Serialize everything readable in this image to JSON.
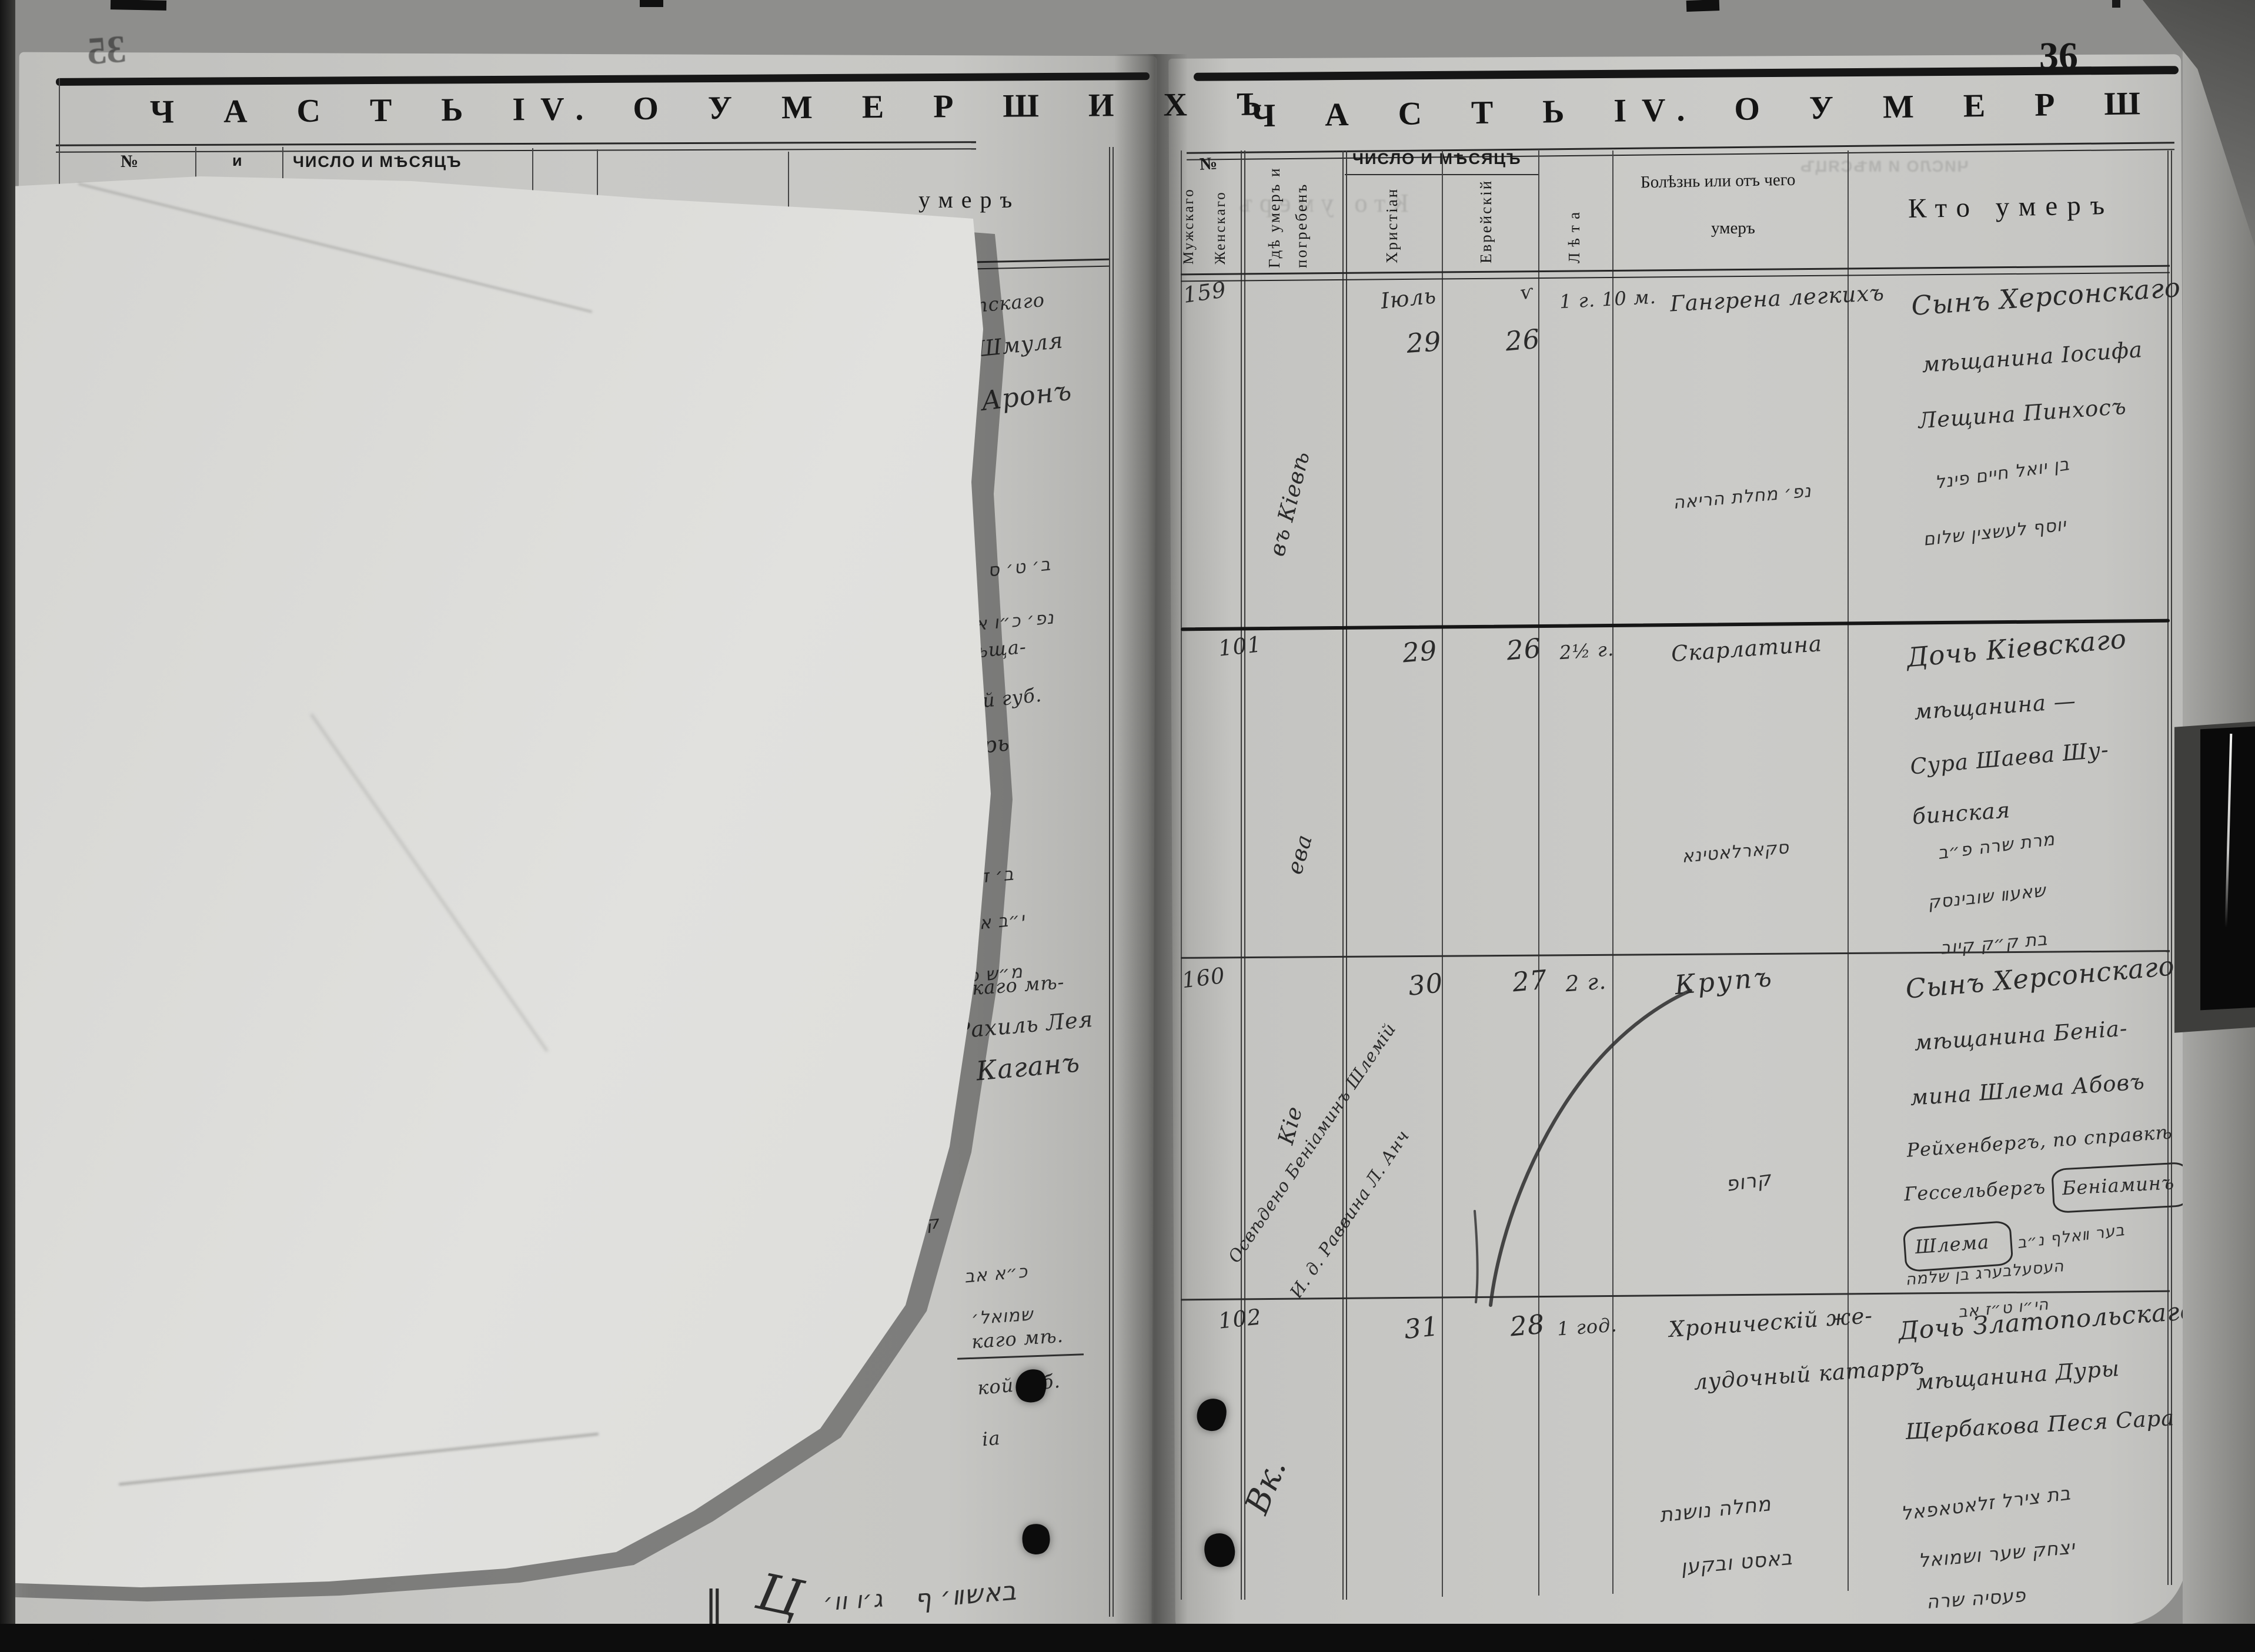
{
  "document_type": "metrical book scan",
  "colors": {
    "page": "#c8c8c5",
    "overlay_paper": "#dededb",
    "ink_printed": "#1a1a1a",
    "ink_handwriting": "#2a2a2a",
    "background": "#8e8e8c",
    "clamp": "#0a0a0a"
  },
  "pages": {
    "left": {
      "page_number": "35",
      "header": "Ч А С Т Ь  IV.  О  У М Е Р Ш И Х Ъ",
      "columns": {
        "no": "№",
        "where_fragment": "и",
        "date": "ЧИСЛО И МѢСЯЦЪ",
        "who_fragment": "умеръ"
      },
      "entries": [
        {
          "lines": [
            "нотопскаго",
            "на Шмуля",
            "та Аронъ"
          ],
          "hebrew": [
            "ב׳ ט׳ ס",
            "נפ׳ כ״ו אב"
          ]
        },
        {
          "lines": [
            "ій мѣща-",
            "вской губ.",
            "окарь"
          ],
          "hebrew": [
            "ב׳ ד",
            "י״ב אלול",
            "מ״ש פ׳"
          ]
        },
        {
          "lines": [
            "нскаго мѣ-",
            "Рахиль Лея",
            "Каганъ"
          ],
          "hebrew": [
            "ק׳ ל׳",
            "כ״א אב",
            "שמואל׳"
          ]
        },
        {
          "lines": [
            "каго мѣ.",
            "кой губ.",
            "іа"
          ],
          "hebrew": []
        }
      ],
      "bottom_marks": {
        "bar": "‖",
        "flourish": "Ц",
        "hebrew_1": "ג׳ו וו׳",
        "hebrew_2": "באשװ׳ ף"
      }
    },
    "right": {
      "page_number": "36",
      "header": "Ч А С Т Ь  IV.  О  У М Е Р Ш И Х Ъ",
      "columns": {
        "no": "№",
        "no_male": "Мужскаго",
        "no_female": "Женскаго",
        "where_1": "Гдѣ умеръ и",
        "where_2": "погребенъ",
        "date_main": "ЧИСЛО И МѢСЯЦЪ",
        "date_christian": "Христіан",
        "date_jewish": "Еврейскій",
        "age": "Лѣта",
        "cause_1": "Болѣзнь или отъ чего",
        "cause_2": "умеръ",
        "who": "Кто умеръ"
      },
      "rows": [
        {
          "no": "159",
          "where_rotated": "въ Кіевѣ",
          "month_christian": "Іюль",
          "day_christian": "29",
          "jewish_mark": "ѵ",
          "day_jewish": "26",
          "age": "1 г. 10 м.",
          "cause": "Гангрена легкихъ",
          "who_lines": [
            "Сынъ Херсонскаго",
            "мѣщанина Іосифа",
            "Лещина Пинхосъ"
          ],
          "cause_hebrew": [
            "נפ׳ מחלת הריאה"
          ],
          "who_hebrew": [
            "בן יואל חיים פינל",
            "יוסף לעשצין שלום"
          ]
        },
        {
          "no": "101",
          "where_rotated": "ева",
          "day_christian": "29",
          "day_jewish": "26",
          "age": "2½ г.",
          "cause": "Скарлатина",
          "who_lines": [
            "Дочь Кіевскаго",
            "мѣщанина —",
            "Сура Шаева Шу-",
            "бинская"
          ],
          "cause_hebrew": [
            "סקארלאטינא"
          ],
          "who_hebrew": [
            "מרת שרה פ״ב",
            "שאעװ שובינסק",
            "בת ק״ק קיוב"
          ]
        },
        {
          "no": "160",
          "where_rotated": "Кіе",
          "margin_note": [
            "Освѣдено Беніаминъ Шлемій",
            "И. д. Раввина Л. Анч"
          ],
          "day_christian": "30",
          "day_jewish": "27",
          "age": "2 г.",
          "cause": "Крупъ",
          "who_lines": [
            "Сынъ Херсонскаго",
            "мѣщанина Беніа-",
            "мина Шлема Абовъ",
            "Рейхенбергъ, по справкѣ",
            "Гессельбергъ"
          ],
          "who_boxed_1": "Беніаминъ",
          "who_boxed_2": "Шлема",
          "cause_hebrew": [
            "קרופ"
          ],
          "who_hebrew": [
            "בער װאלף נ״ב",
            "העסעלבערג בן שלמה",
            "הי״ו ט״ז אב"
          ]
        },
        {
          "no": "102",
          "where_rotated": "Вк.",
          "day_christian": "31",
          "day_jewish": "28",
          "age": "1 год.",
          "cause_lines": [
            "Хроническій же-",
            "лудочный катарръ"
          ],
          "who_lines": [
            "Дочь Златопольскаго",
            "мѣщанина Дуры",
            "Щербакова Песя Сара"
          ],
          "cause_hebrew": [
            "מחלה נושנת",
            "באסט ובקען"
          ],
          "who_hebrew": [
            "בת צירל זלאטאפאל",
            "יצחק שער ושמואל",
            "פעסיה שרה"
          ]
        }
      ]
    }
  }
}
